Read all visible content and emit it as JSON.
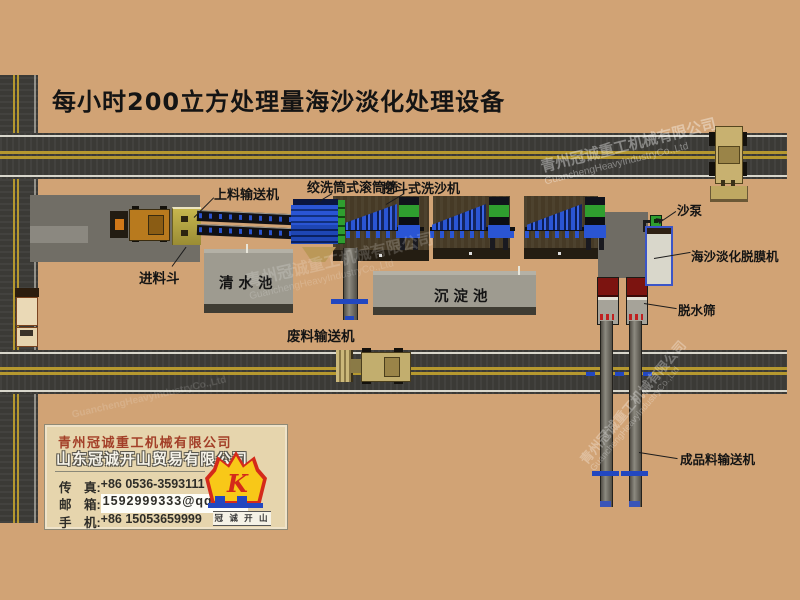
{
  "title": "每小时200立方处理量海沙淡化处理设备",
  "equipment_labels": {
    "feed_conveyor": "上料输送机",
    "drum_screen": "绞洗筒式滚筒筛",
    "bucket_washer": "挖斗式洗沙机",
    "sand_pump": "沙泵",
    "feed_hopper": "进料斗",
    "clear_water_pool": "清水池",
    "sedimentation_pool": "沉淀池",
    "desalination_machine": "海沙淡化脱膜机",
    "dewatering_screen": "脱水筛",
    "waste_conveyor": "废料输送机",
    "product_conveyor": "成品料输送机"
  },
  "company_card": {
    "company_primary": "青州冠诚重工机械有限公司",
    "company_secondary": "山东冠诚开山贸易有限公司",
    "fax_label": "传　真:",
    "fax_value": "+86 0536-3593111",
    "email_label": "邮　箱:",
    "email_value": "1592999333@qq.com",
    "mobile_label": "手　机:",
    "mobile_value": "+86 15053659999",
    "logo_glyph": "K",
    "logo_caption": "冠 诚 开 山"
  },
  "watermark": {
    "cn": "青州冠诚重工机械有限公司",
    "en": "GuanchengHeavyIndustryCo.,Ltd"
  },
  "colors": {
    "background": "#d1a375",
    "road": "#3b3a36",
    "road_line_yellow": "#b5982f",
    "machine_blue": "#2a55d4",
    "machine_green": "#2f9e2f",
    "screen_red": "#7c1410",
    "logo_yellow": "#f8c818",
    "logo_red": "#d42a1a",
    "logo_blue": "#2247c0"
  }
}
